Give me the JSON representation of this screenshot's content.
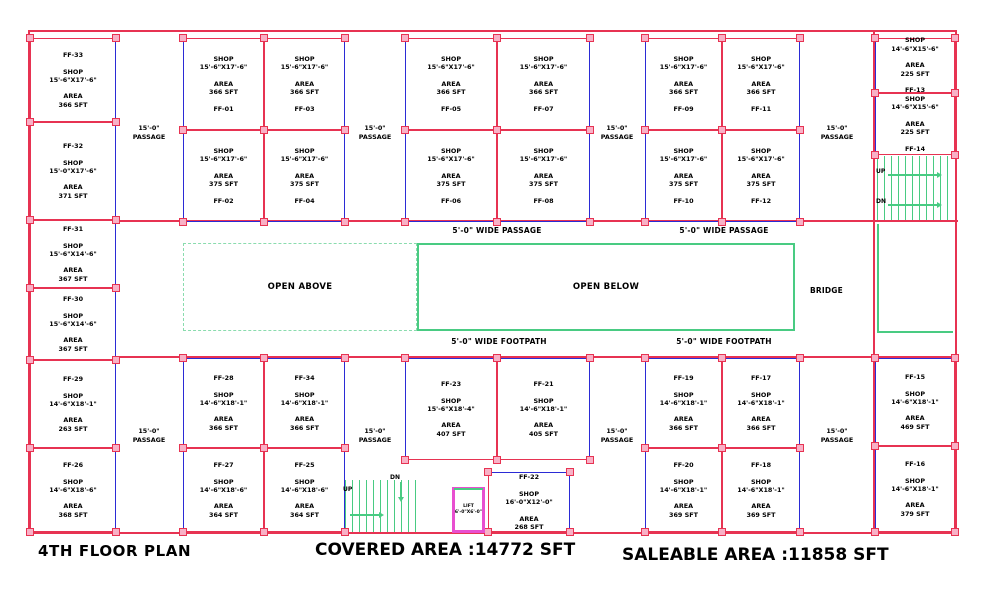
{
  "title": {
    "floor": "4TH FLOOR PLAN",
    "covered": "COVERED AREA :14772 SFT",
    "saleable": "SALEABLE AREA :11858 SFT"
  },
  "labels": {
    "area": "AREA",
    "passage": "15'-0\"\nPASSAGE",
    "wide_passage": "5'-0\" WIDE PASSAGE",
    "wide_footpath": "5'-0\" WIDE FOOTPATH",
    "open_above": "OPEN ABOVE",
    "open_below": "OPEN BELOW",
    "bridge": "BRIDGE",
    "up": "UP",
    "dn": "DN",
    "lift": "LIFT\n6'-0\"X6'-0\""
  },
  "colors": {
    "wall": "#e73352",
    "column_fill": "#f8b1c6",
    "shopfront_blue": "#2b2bd5",
    "stair_green": "#49cb82",
    "open_above_dashed": "#8adcae",
    "lift_magenta": "#e84fd0",
    "text": "#000000"
  },
  "rooms": [
    {
      "id": "FF-01",
      "type": "SHOP",
      "dims": "15'-6\"X17'-6\"",
      "area": "366 SFT",
      "name_pos": "bottom"
    },
    {
      "id": "FF-02",
      "type": "SHOP",
      "dims": "15'-6\"X17'-6\"",
      "area": "375 SFT",
      "name_pos": "bottom"
    },
    {
      "id": "FF-03",
      "type": "SHOP",
      "dims": "15'-6\"X17'-6\"",
      "area": "366 SFT",
      "name_pos": "bottom"
    },
    {
      "id": "FF-04",
      "type": "SHOP",
      "dims": "15'-6\"X17'-6\"",
      "area": "375 SFT",
      "name_pos": "bottom"
    },
    {
      "id": "FF-05",
      "type": "SHOP",
      "dims": "15'-6\"X17'-6\"",
      "area": "366 SFT",
      "name_pos": "bottom"
    },
    {
      "id": "FF-06",
      "type": "SHOP",
      "dims": "15'-6\"X17'-6\"",
      "area": "375 SFT",
      "name_pos": "bottom"
    },
    {
      "id": "FF-07",
      "type": "SHOP",
      "dims": "15'-6\"X17'-6\"",
      "area": "366 SFT",
      "name_pos": "bottom"
    },
    {
      "id": "FF-08",
      "type": "SHOP",
      "dims": "15'-6\"X17'-6\"",
      "area": "375 SFT",
      "name_pos": "bottom"
    },
    {
      "id": "FF-09",
      "type": "SHOP",
      "dims": "15'-6\"X17'-6\"",
      "area": "366 SFT",
      "name_pos": "bottom"
    },
    {
      "id": "FF-10",
      "type": "SHOP",
      "dims": "15'-6\"X17'-6\"",
      "area": "375 SFT",
      "name_pos": "bottom"
    },
    {
      "id": "FF-11",
      "type": "SHOP",
      "dims": "15'-6\"X17'-6\"",
      "area": "366 SFT",
      "name_pos": "bottom"
    },
    {
      "id": "FF-12",
      "type": "SHOP",
      "dims": "15'-6\"X17'-6\"",
      "area": "375 SFT",
      "name_pos": "bottom"
    },
    {
      "id": "FF-13",
      "type": "SHOP",
      "dims": "14'-6\"X15'-6\"",
      "area": "225 SFT",
      "name_pos": "bottom"
    },
    {
      "id": "FF-14",
      "type": "SHOP",
      "dims": "14'-6\"X15'-6\"",
      "area": "225 SFT",
      "name_pos": "bottom"
    },
    {
      "id": "FF-15",
      "type": "SHOP",
      "dims": "14'-6\"X18'-1\"",
      "area": "469 SFT",
      "name_pos": "top"
    },
    {
      "id": "FF-16",
      "type": "SHOP",
      "dims": "14'-6\"X18'-1\"",
      "area": "379 SFT",
      "name_pos": "top"
    },
    {
      "id": "FF-17",
      "type": "SHOP",
      "dims": "14'-6\"X18'-1\"",
      "area": "366 SFT",
      "name_pos": "top"
    },
    {
      "id": "FF-18",
      "type": "SHOP",
      "dims": "14'-6\"X18'-1\"",
      "area": "369 SFT",
      "name_pos": "top"
    },
    {
      "id": "FF-19",
      "type": "SHOP",
      "dims": "14'-6\"X18'-1\"",
      "area": "366 SFT",
      "name_pos": "top"
    },
    {
      "id": "FF-20",
      "type": "SHOP",
      "dims": "14'-6\"X18'-1\"",
      "area": "369 SFT",
      "name_pos": "top"
    },
    {
      "id": "FF-21",
      "type": "SHOP",
      "dims": "14'-6\"X18'-1\"",
      "area": "405 SFT",
      "name_pos": "top"
    },
    {
      "id": "FF-22",
      "type": "SHOP",
      "dims": "16'-0\"X12'-0\"",
      "area": "268 SFT",
      "name_pos": "top"
    },
    {
      "id": "FF-23",
      "type": "SHOP",
      "dims": "15'-6\"X18'-4\"",
      "area": "407 SFT",
      "name_pos": "top"
    },
    {
      "id": "FF-25",
      "type": "SHOP",
      "dims": "14'-6\"X18'-6\"",
      "area": "364 SFT",
      "name_pos": "top"
    },
    {
      "id": "FF-26",
      "type": "SHOP",
      "dims": "14'-6\"X18'-6\"",
      "area": "368 SFT",
      "name_pos": "top"
    },
    {
      "id": "FF-27",
      "type": "SHOP",
      "dims": "14'-6\"X18'-6\"",
      "area": "364 SFT",
      "name_pos": "top"
    },
    {
      "id": "FF-28",
      "type": "SHOP",
      "dims": "14'-6\"X18'-1\"",
      "area": "366 SFT",
      "name_pos": "top"
    },
    {
      "id": "FF-29",
      "type": "SHOP",
      "dims": "14'-6\"X18'-1\"",
      "area": "263 SFT",
      "name_pos": "top"
    },
    {
      "id": "FF-30",
      "type": "SHOP",
      "dims": "15'-6\"X14'-6\"",
      "area": "367 SFT",
      "name_pos": "top"
    },
    {
      "id": "FF-31",
      "type": "SHOP",
      "dims": "15'-6\"X14'-6\"",
      "area": "367 SFT",
      "name_pos": "top"
    },
    {
      "id": "FF-32",
      "type": "SHOP",
      "dims": "15'-0\"X17'-6\"",
      "area": "371 SFT",
      "name_pos": "top"
    },
    {
      "id": "FF-33",
      "type": "SHOP",
      "dims": "15'-6\"X17'-6\"",
      "area": "366 SFT",
      "name_pos": "top"
    },
    {
      "id": "FF-34",
      "type": "SHOP",
      "dims": "14'-6\"X18'-1\"",
      "area": "366 SFT",
      "name_pos": "top"
    }
  ]
}
